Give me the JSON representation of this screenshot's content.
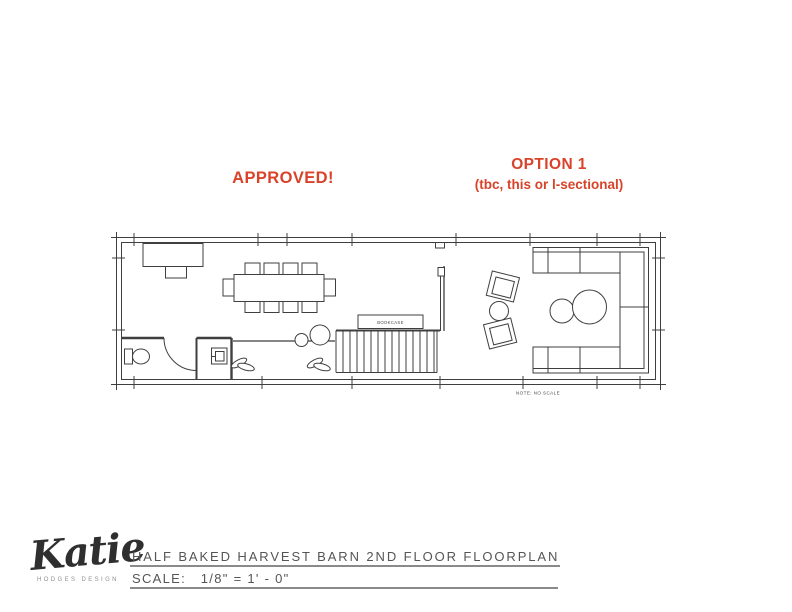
{
  "annotations": {
    "approved_label": "APPROVED!",
    "option_title": "OPTION 1",
    "option_subtitle": "(tbc, this or l-sectional)",
    "accent_color": "#d8432a"
  },
  "floorplan": {
    "bookcase_label": "BOOKCASE",
    "note_text": "NOTE: NO SCALE"
  },
  "title_block": {
    "logo_name": "Katie",
    "logo_tagline": "HODGES DESIGN",
    "drawing_title": "HALF BAKED HARVEST BARN 2ND FLOOR FLOORPLAN",
    "scale_label": "SCALE:   1/8\" = 1' - 0\""
  }
}
